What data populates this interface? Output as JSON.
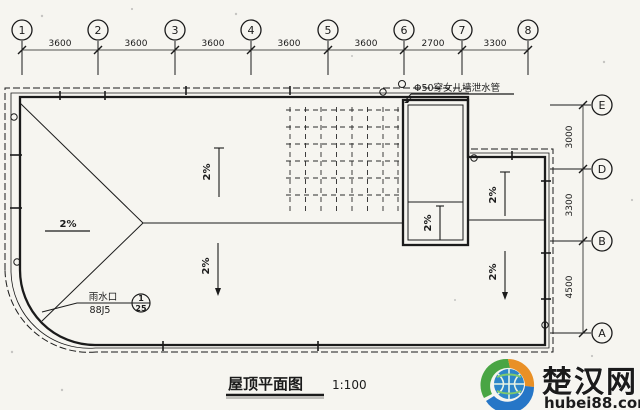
{
  "page": {
    "background": "#f6f5f0",
    "ink": "#1b1b1b"
  },
  "title_block": {
    "title": "屋顶平面图",
    "scale": "1:100"
  },
  "grid": {
    "columns": [
      "1",
      "2",
      "3",
      "4",
      "5",
      "6",
      "7",
      "8"
    ],
    "column_dims": [
      "3600",
      "3600",
      "3600",
      "3600",
      "3600",
      "2700",
      "3300"
    ],
    "rows": [
      "E",
      "D",
      "B",
      "A"
    ],
    "row_dims": [
      "3000",
      "3300",
      "4500"
    ]
  },
  "annotations": {
    "drain_pipe": "Φ50穿女儿墙泄水管",
    "rain_outlet_line1": "雨水口",
    "rain_outlet_line2": "88J5",
    "detail_ref_top": "1",
    "detail_ref_bottom": "25"
  },
  "slopes": [
    "2%",
    "2%",
    "2%",
    "2%",
    "2%",
    "2%",
    "2%"
  ],
  "watermark": {
    "name": "楚汉网",
    "url": "hubei88.com",
    "brand_blue": "#1b4fc4",
    "logo_green": "#3fa03a",
    "logo_orange": "#e88a1a",
    "logo_blue": "#1a6fc4"
  }
}
